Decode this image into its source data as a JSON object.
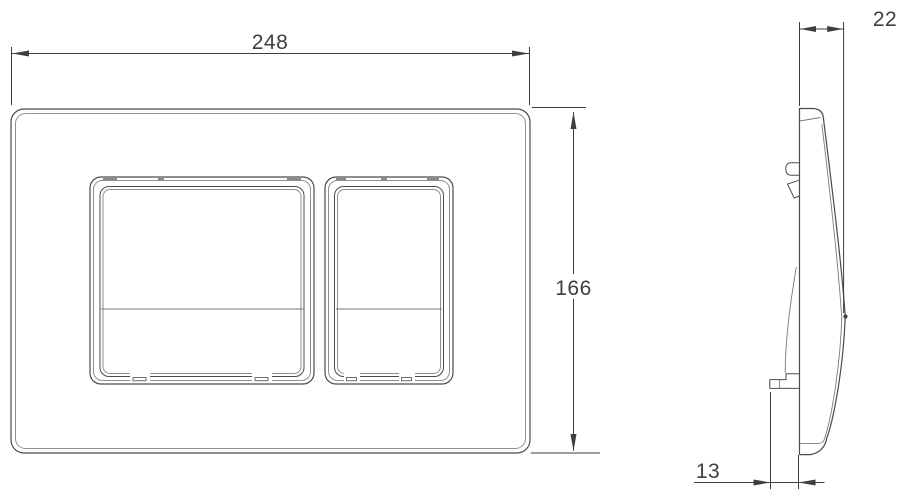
{
  "drawing": {
    "dimension_labels": {
      "width": "248",
      "height": "166",
      "depth": "22",
      "offset": "13"
    },
    "colors": {
      "background": "#ffffff",
      "outline": "#4b4b4b",
      "outline_light": "#8f8f8f",
      "dimension": "#3e3e3e",
      "text": "#3e3e3e"
    }
  }
}
